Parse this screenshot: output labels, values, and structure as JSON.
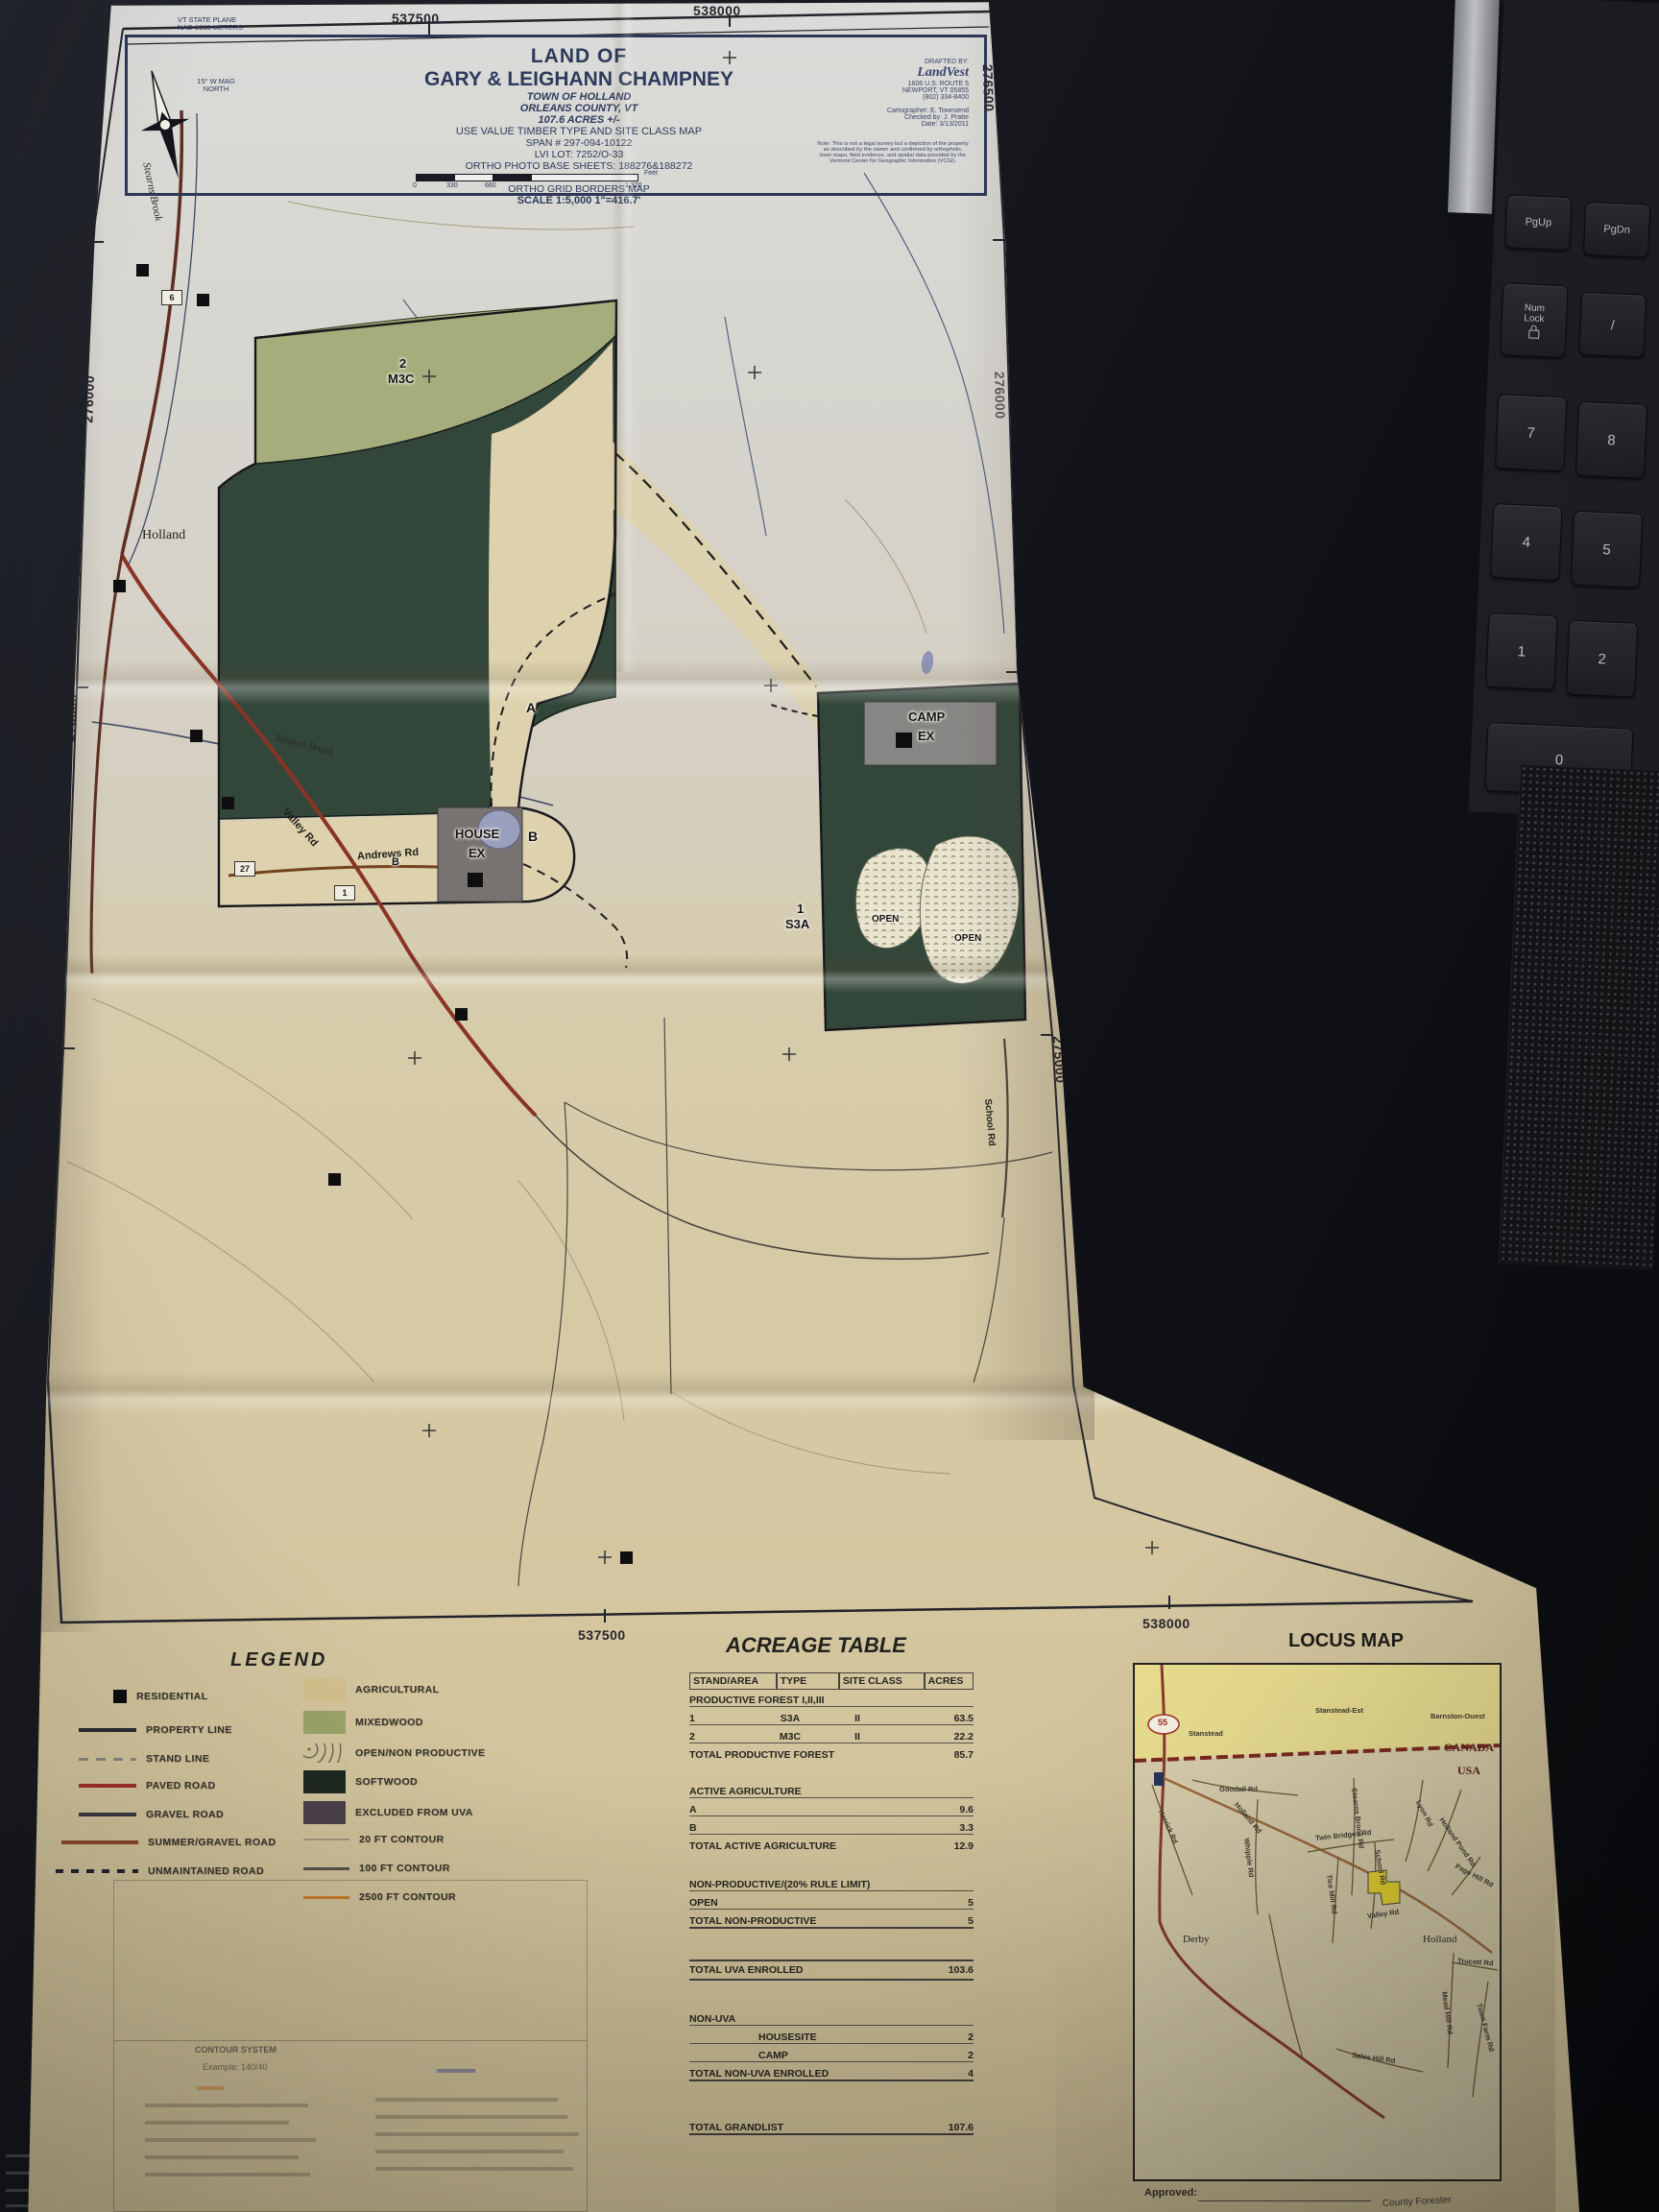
{
  "meta": {
    "approved_label": "Approved:",
    "forester_label": "County Forester"
  },
  "colors": {
    "paper_tan": "#d5c9a6",
    "softwood_dark": "#33463a",
    "mixedwood_green": "#a6ad7c",
    "agriculture_tan": "#ddd2ad",
    "paved_road_red": "#8a3326",
    "canada_yellow": "#e9dd90",
    "title_navy": "#2e3a5c",
    "excluded_grey": "#787270"
  },
  "keyboard": {
    "keys": [
      {
        "label": "PgUp"
      },
      {
        "label": "PgDn"
      },
      {
        "label": "Num Lock"
      },
      {
        "label": "/"
      },
      {
        "label": "7"
      },
      {
        "label": "8"
      },
      {
        "label": "4"
      },
      {
        "label": "5"
      },
      {
        "label": "1"
      },
      {
        "label": "2"
      },
      {
        "label": "0"
      }
    ]
  },
  "title_block": {
    "land_of": "LAND OF",
    "owners": "GARY & LEIGHANN CHAMPNEY",
    "town": "TOWN OF HOLLAND",
    "county": "ORLEANS COUNTY, VT",
    "acres": "107.6 ACRES +/-",
    "map_type": "USE VALUE TIMBER TYPE AND SITE CLASS MAP",
    "span": "SPAN # 297-094-10122",
    "lvi_lot": "LVI LOT: 7252/O-33",
    "ortho": "ORTHO PHOTO BASE SHEETS: 188276&188272",
    "series": "SERIES 5000 2008",
    "borders": "ORTHO GRID BORDERS MAP",
    "scale": "SCALE 1:5,000   1\"=416.7'",
    "feet": "Feet",
    "scale_ticks": [
      "0",
      "330",
      "660",
      "1,320"
    ],
    "mag": "15° W MAG NORTH",
    "plane": "VT STATE PLANE",
    "datum": "NAD 1983 METERS"
  },
  "credits": {
    "drafted_by": "DRAFTED BY:",
    "company": "LandVest",
    "addr1": "1606 U.S. ROUTE 5",
    "addr2": "NEWPORT, VT 05855",
    "addr3": "(802) 334-8400",
    "cartographer": "Cartographer: E. Townsend",
    "checked": "Checked by: J. Pratte",
    "date": "Date: 3/13/2011",
    "note": "Note: This is not a legal survey but a depiction of the property as described by the owner and confirmed by orthophoto, town maps, field evidence, and spatial data provided by the Vermont Center for Geographic Information (VCGI)."
  },
  "grid": {
    "top": [
      "537500",
      "538000"
    ],
    "bottom": [
      "537500",
      "538000"
    ],
    "left": [
      "276500",
      "276000",
      "275500",
      "275000"
    ],
    "right": [
      "276500",
      "276000",
      "275500",
      "275000"
    ]
  },
  "map": {
    "stand2_num": "2",
    "stand2_type": "M3C",
    "stand1_num": "1",
    "stand1_type": "S3A",
    "area_a": "A",
    "area_b": "B",
    "area_b2": "B",
    "open1": "OPEN",
    "open2": "OPEN",
    "camp_line1": "CAMP",
    "camp_line2": "EX",
    "house_line1": "HOUSE",
    "house_line2": "EX",
    "town": "Holland",
    "andrews_rd": "Andrews Rd",
    "valley_rd": "Valley Rd",
    "stearns_brook_upper": "Stearns Brook",
    "stearns_brook_lower": "Stearns Brook",
    "school_rd": "School Rd",
    "badge6": "6",
    "badge27": "27",
    "badge1": "1"
  },
  "legend": {
    "title": "LEGEND",
    "left": [
      {
        "label": "RESIDENTIAL"
      },
      {
        "label": "PROPERTY LINE"
      },
      {
        "label": "STAND LINE"
      },
      {
        "label": "PAVED ROAD"
      },
      {
        "label": "GRAVEL ROAD"
      },
      {
        "label": "SUMMER/GRAVEL ROAD"
      },
      {
        "label": "UNMAINTAINED ROAD"
      }
    ],
    "right": [
      {
        "label": "AGRICULTURAL",
        "color": "#d2c08c"
      },
      {
        "label": "MIXEDWOOD",
        "color": "#9aa468"
      },
      {
        "label": "OPEN/NON PRODUCTIVE"
      },
      {
        "label": "SOFTWOOD",
        "color": "#20291f"
      },
      {
        "label": "EXCLUDED FROM UVA",
        "color": "#4c434a"
      },
      {
        "label": "20 FT CONTOUR"
      },
      {
        "label": "100 FT CONTOUR"
      },
      {
        "label": "2500 FT CONTOUR"
      }
    ]
  },
  "acreage": {
    "title": "ACREAGE TABLE",
    "headers": [
      "STAND/AREA",
      "TYPE",
      "SITE CLASS",
      "ACRES"
    ],
    "sections": [
      {
        "heading": "PRODUCTIVE FOREST I,II,III",
        "rows": [
          [
            "1",
            "S3A",
            "II",
            "63.5"
          ],
          [
            "2",
            "M3C",
            "II",
            "22.2"
          ]
        ],
        "total_label": "TOTAL PRODUCTIVE FOREST",
        "total": "85.7"
      },
      {
        "heading": "ACTIVE AGRICULTURE",
        "rows": [
          [
            "A",
            "",
            "",
            "9.6"
          ],
          [
            "B",
            "",
            "",
            "3.3"
          ]
        ],
        "total_label": "TOTAL ACTIVE AGRICULTURE",
        "total": "12.9"
      },
      {
        "heading": "NON-PRODUCTIVE/(20% RULE LIMIT)",
        "rows": [
          [
            "OPEN",
            "",
            "",
            "5"
          ]
        ],
        "total_label": "TOTAL NON-PRODUCTIVE",
        "total": "5"
      }
    ],
    "uva_label": "TOTAL UVA ENROLLED",
    "uva_total": "103.6",
    "nonuva_heading": "NON-UVA",
    "nonuva_rows": [
      [
        "HOUSESITE",
        "2"
      ],
      [
        "CAMP",
        "2"
      ]
    ],
    "nonuva_label": "TOTAL NON-UVA ENROLLED",
    "nonuva_total": "4",
    "grand_label": "TOTAL GRANDLIST",
    "grand_total": "107.6"
  },
  "locus": {
    "title": "LOCUS MAP",
    "canada": "CANADA",
    "usa": "USA",
    "route": "55",
    "places": {
      "stanstead": "Stanstead",
      "stanstead_est": "Stanstead-Est",
      "barnston": "Barnston-Ouest",
      "holland": "Holland",
      "derby": "Derby"
    },
    "roads": {
      "goodall": "Goodall Rd",
      "herrick": "Herrick Rd",
      "holland_rd": "Holland Rd",
      "whipple": "Whipple Rd",
      "twin_bridges": "Twin Bridges Rd",
      "stearns_brook": "Stearns Brook Rd",
      "school": "School Rd",
      "lyon": "Lyon Rd",
      "holland_pond": "Holland Pond Rd",
      "page_hill": "Page Hill Rd",
      "tice_mill": "Tice Mill Rd",
      "valley": "Valley Rd",
      "mead_hill": "Mead Hill Rd",
      "town_farm": "Town Farm Rd",
      "trucott": "Trucott Rd",
      "sales_hill": "Sales Hill Rd"
    }
  },
  "contour_note": {
    "title": "CONTOUR SYSTEM",
    "example": "Example: 140/40"
  }
}
